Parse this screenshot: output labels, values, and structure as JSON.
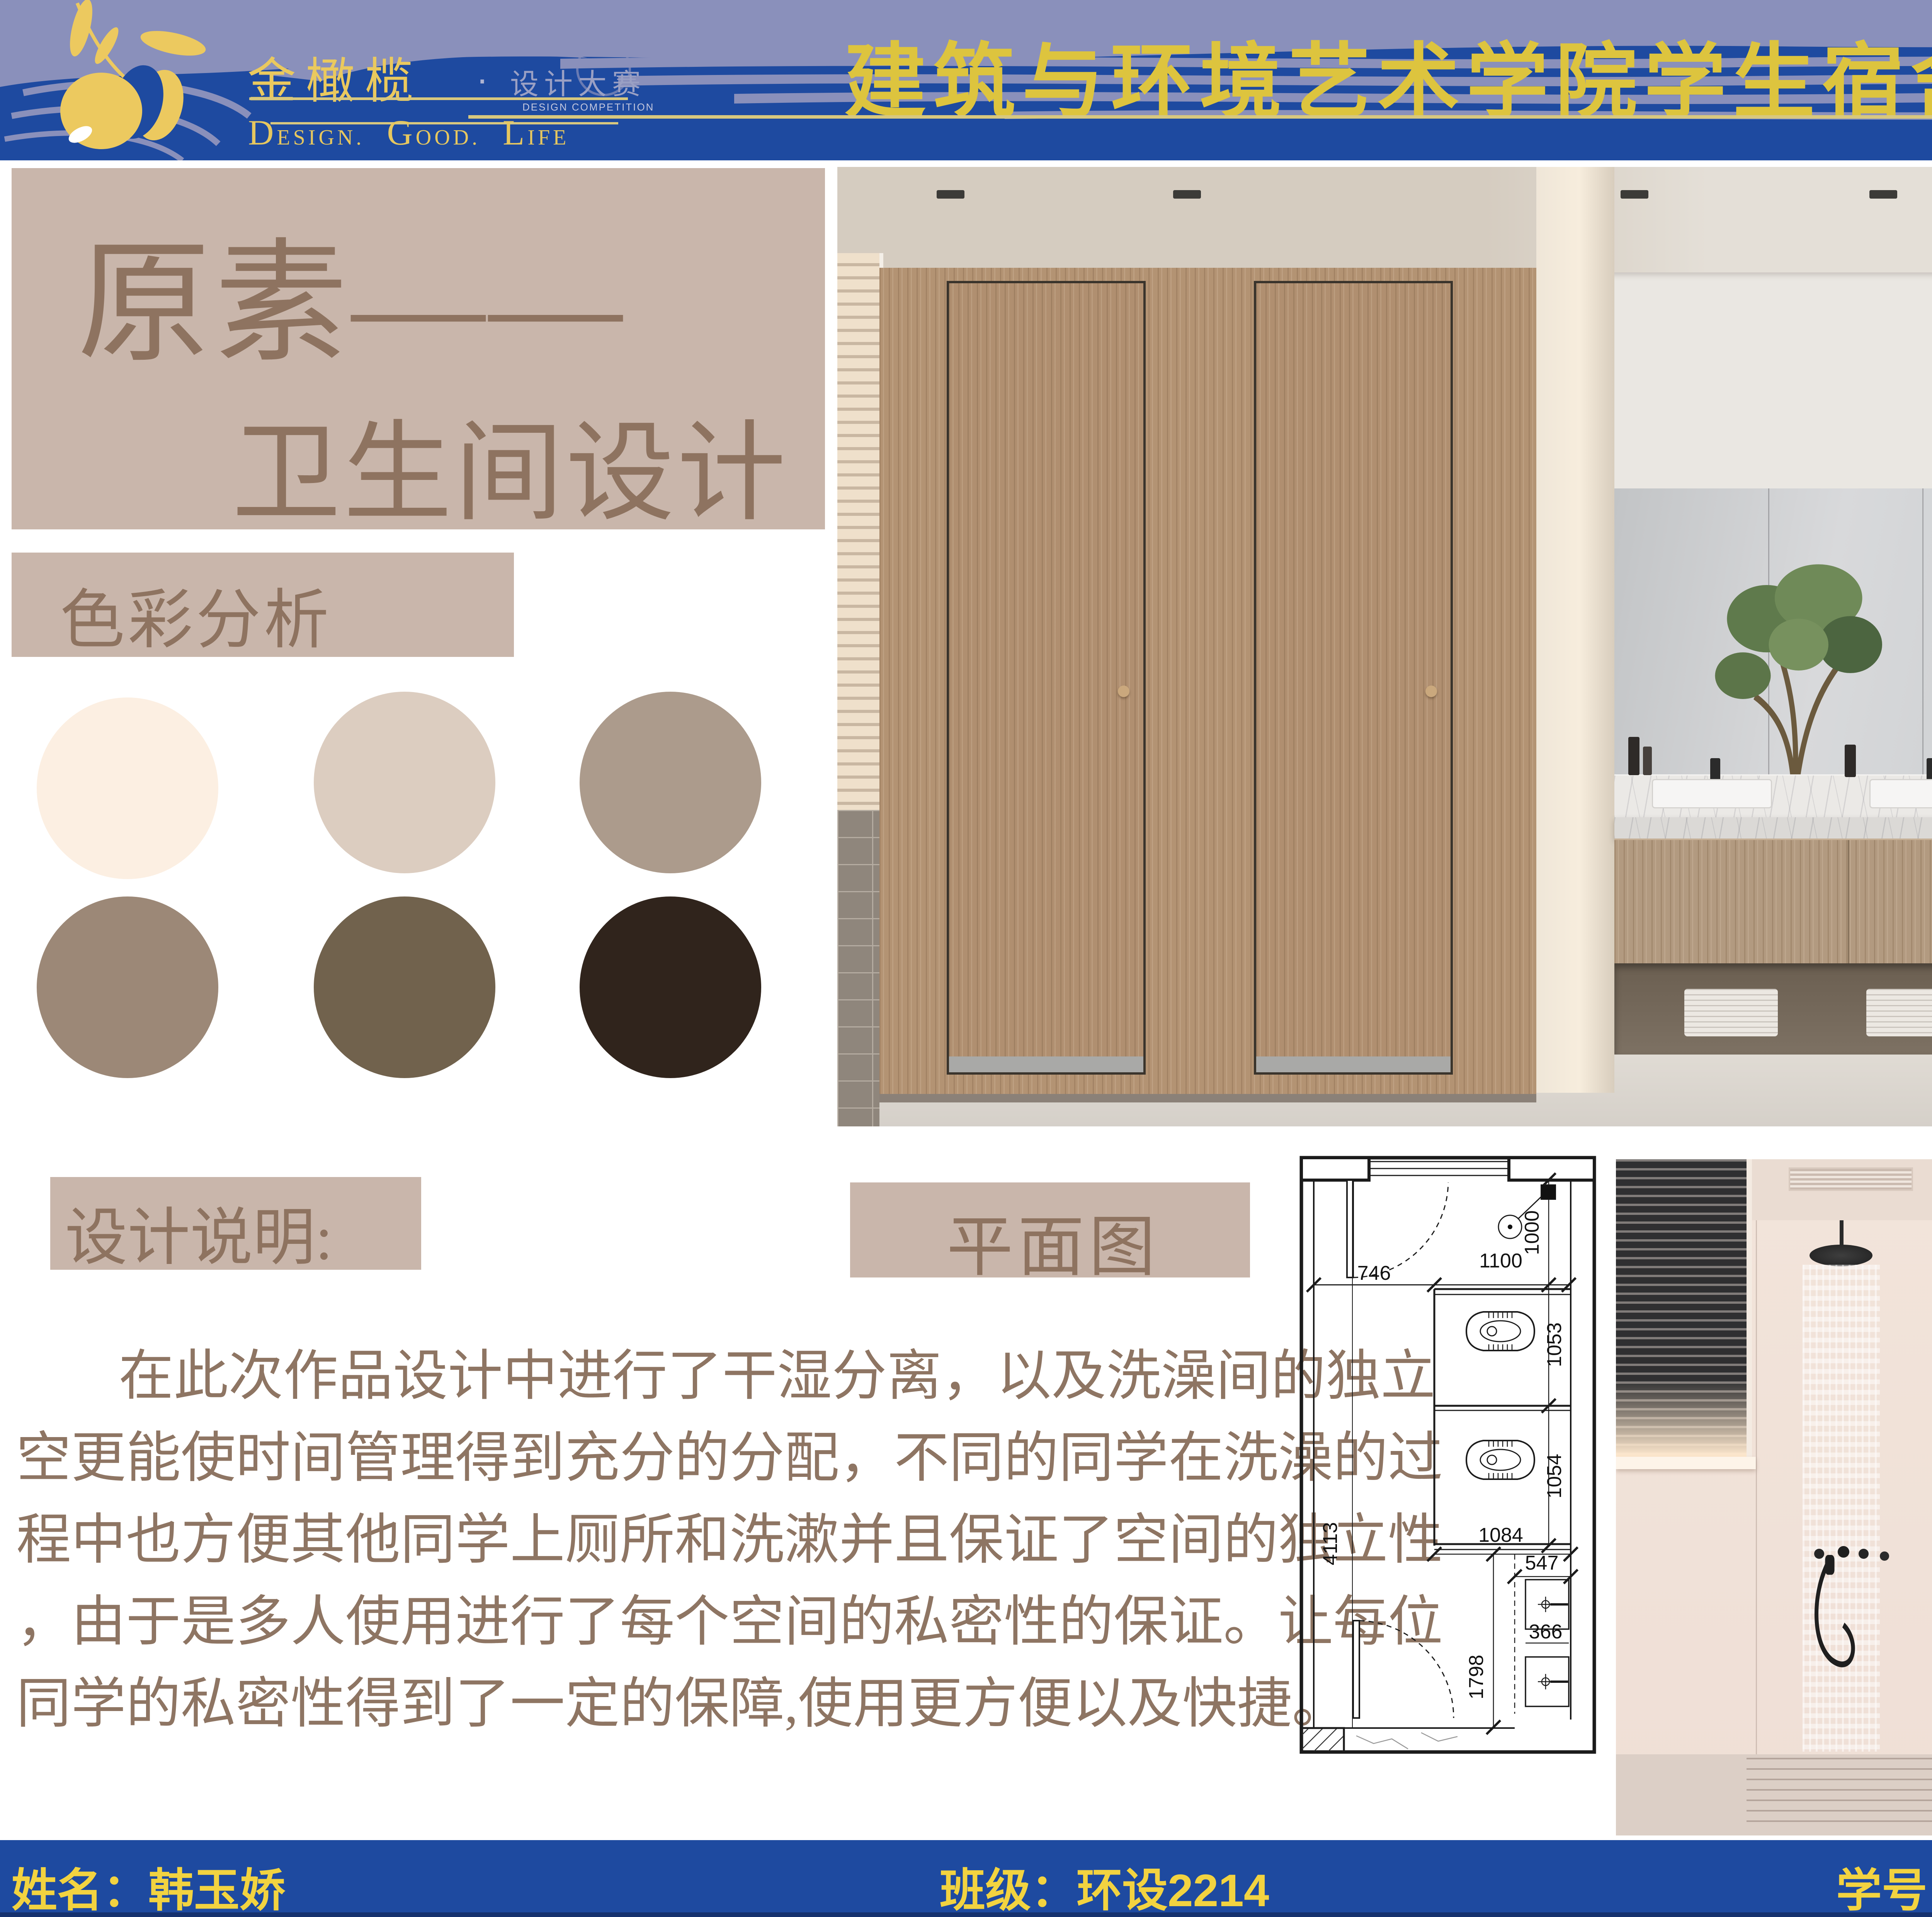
{
  "header": {
    "logo": {
      "brand": "金橄榄",
      "dot": "·",
      "brand2": "设计大赛",
      "small": "DESIGN COMPETITION",
      "tag": {
        "w1c": "D",
        "w1r": "ESIGN.",
        "w2c": "G",
        "w2r": "OOD.",
        "w3c": "L",
        "w3r": "IFE"
      }
    },
    "title": "建筑与环境艺术学院学生宿舍卫生间设计大赛"
  },
  "left": {
    "title1": "原素——",
    "title2": "卫生间设计",
    "palette_heading": "色彩分析",
    "palette": [
      "#fcefe2",
      "#dccdc0",
      "#ac9b8c",
      "#9c8877",
      "#71624d",
      "#30241c"
    ],
    "note_heading": "设计说明:",
    "note_lines": [
      "在此次作品设计中进行了干湿分离，以及洗澡间的独立",
      "空更能使时间管理得到充分的分配，不同的同学在洗澡的过",
      "程中也方便其他同学上厕所和洗漱并且保证了空间的独立性",
      "，由于是多人使用进行了每个空间的私密性的保证。让每位",
      "同学的私密性得到了一定的保障,使用更方便以及快捷。"
    ]
  },
  "plan": {
    "heading": "平面图",
    "dims": {
      "d746": "746",
      "d1100": "1100",
      "d1000": "1000",
      "d1053": "1053",
      "d1054": "1054",
      "d1084": "1084",
      "d547": "547",
      "d4113": "4113",
      "d1798": "1798",
      "d366": "366"
    }
  },
  "footer": {
    "name": "姓名：韩玉娇",
    "class": "班级：环设2214",
    "student_id": "学号：202240397"
  }
}
